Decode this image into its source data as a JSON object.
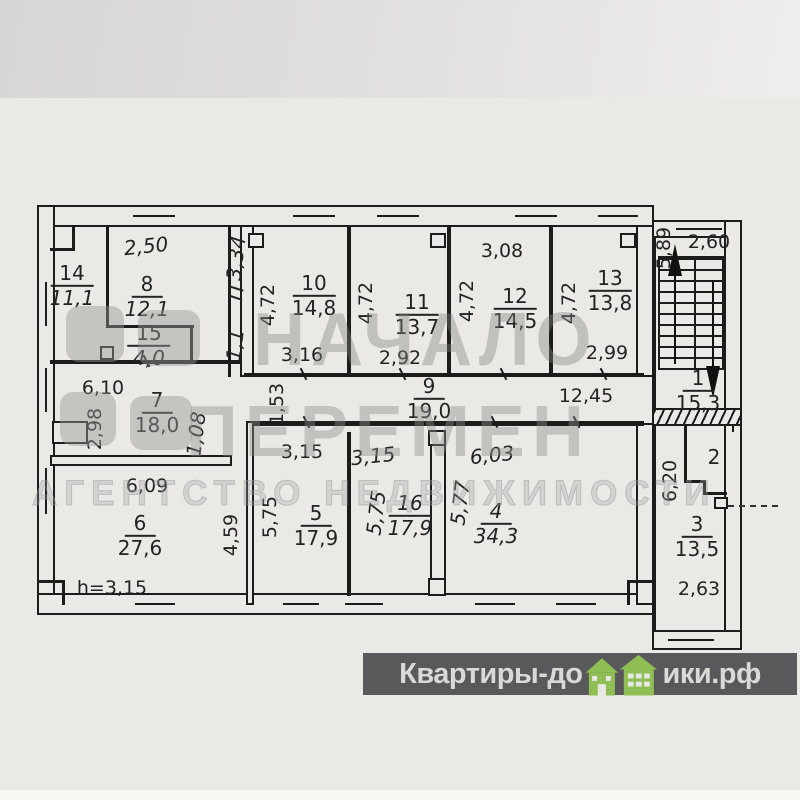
{
  "watermark": {
    "line1": "НАЧАЛО",
    "line2": "ПЕРЕМЕН",
    "line3": "АГЕНТСТВО НЕДВИЖИМОСТИ"
  },
  "footer": {
    "brand_prefix": "Квартиры-до",
    "brand_suffix": "ики.рф",
    "bar_color": "#59585a",
    "text_color": "#d9d9d7",
    "house_color": "#8fbe54"
  },
  "plan": {
    "height_note": "h=3,15",
    "rooms": {
      "r1": {
        "num": "1",
        "area": "15,3"
      },
      "r2": {
        "num": "2",
        "area": ""
      },
      "r3": {
        "num": "3",
        "area": "13,5"
      },
      "r4": {
        "num": "4",
        "area": "34,3"
      },
      "r5": {
        "num": "5",
        "area": "17,9"
      },
      "r6": {
        "num": "6",
        "area": "27,6"
      },
      "r7": {
        "num": "7",
        "area": "18,0"
      },
      "r8": {
        "num": "8",
        "area": "12,1"
      },
      "r9": {
        "num": "9",
        "area": "19,0"
      },
      "r10": {
        "num": "10",
        "area": "14,8"
      },
      "r11": {
        "num": "11",
        "area": "13,7"
      },
      "r12": {
        "num": "12",
        "area": "14,5"
      },
      "r13": {
        "num": "13",
        "area": "13,8"
      },
      "r14": {
        "num": "14",
        "area": "11,1"
      },
      "r15": {
        "num": "15",
        "area": "4,0"
      },
      "r16": {
        "num": "16",
        "area": "17,9"
      }
    },
    "dims": {
      "room8_top": "2,50",
      "shaft_h": "3,34",
      "shaft_door": "П",
      "shaft_w": "1,1",
      "room10_h": "4,72",
      "room11_h": "4,72",
      "room12_h": "4,72",
      "room13_h": "4,72",
      "room10_w": "3,16",
      "room11_w": "2,92",
      "room12_top": "3,08",
      "room13_w": "2,99",
      "stair_h": "5,89",
      "stair_w": "2,60",
      "room7_top": "6,10",
      "corr_left": "1,53",
      "corr_right": "12,45",
      "room7_niche": "2,98",
      "room7_right": "1,08",
      "room5_top": "3,15",
      "room16_top": "3,15",
      "room4_top": "6,03",
      "room6_top": "6,09",
      "room6_h": "4,59",
      "room5_h": "5,75",
      "room16_h": "5,75",
      "room4_h": "5,77",
      "hall_h": "6,20",
      "room3_w": "2,63"
    }
  }
}
